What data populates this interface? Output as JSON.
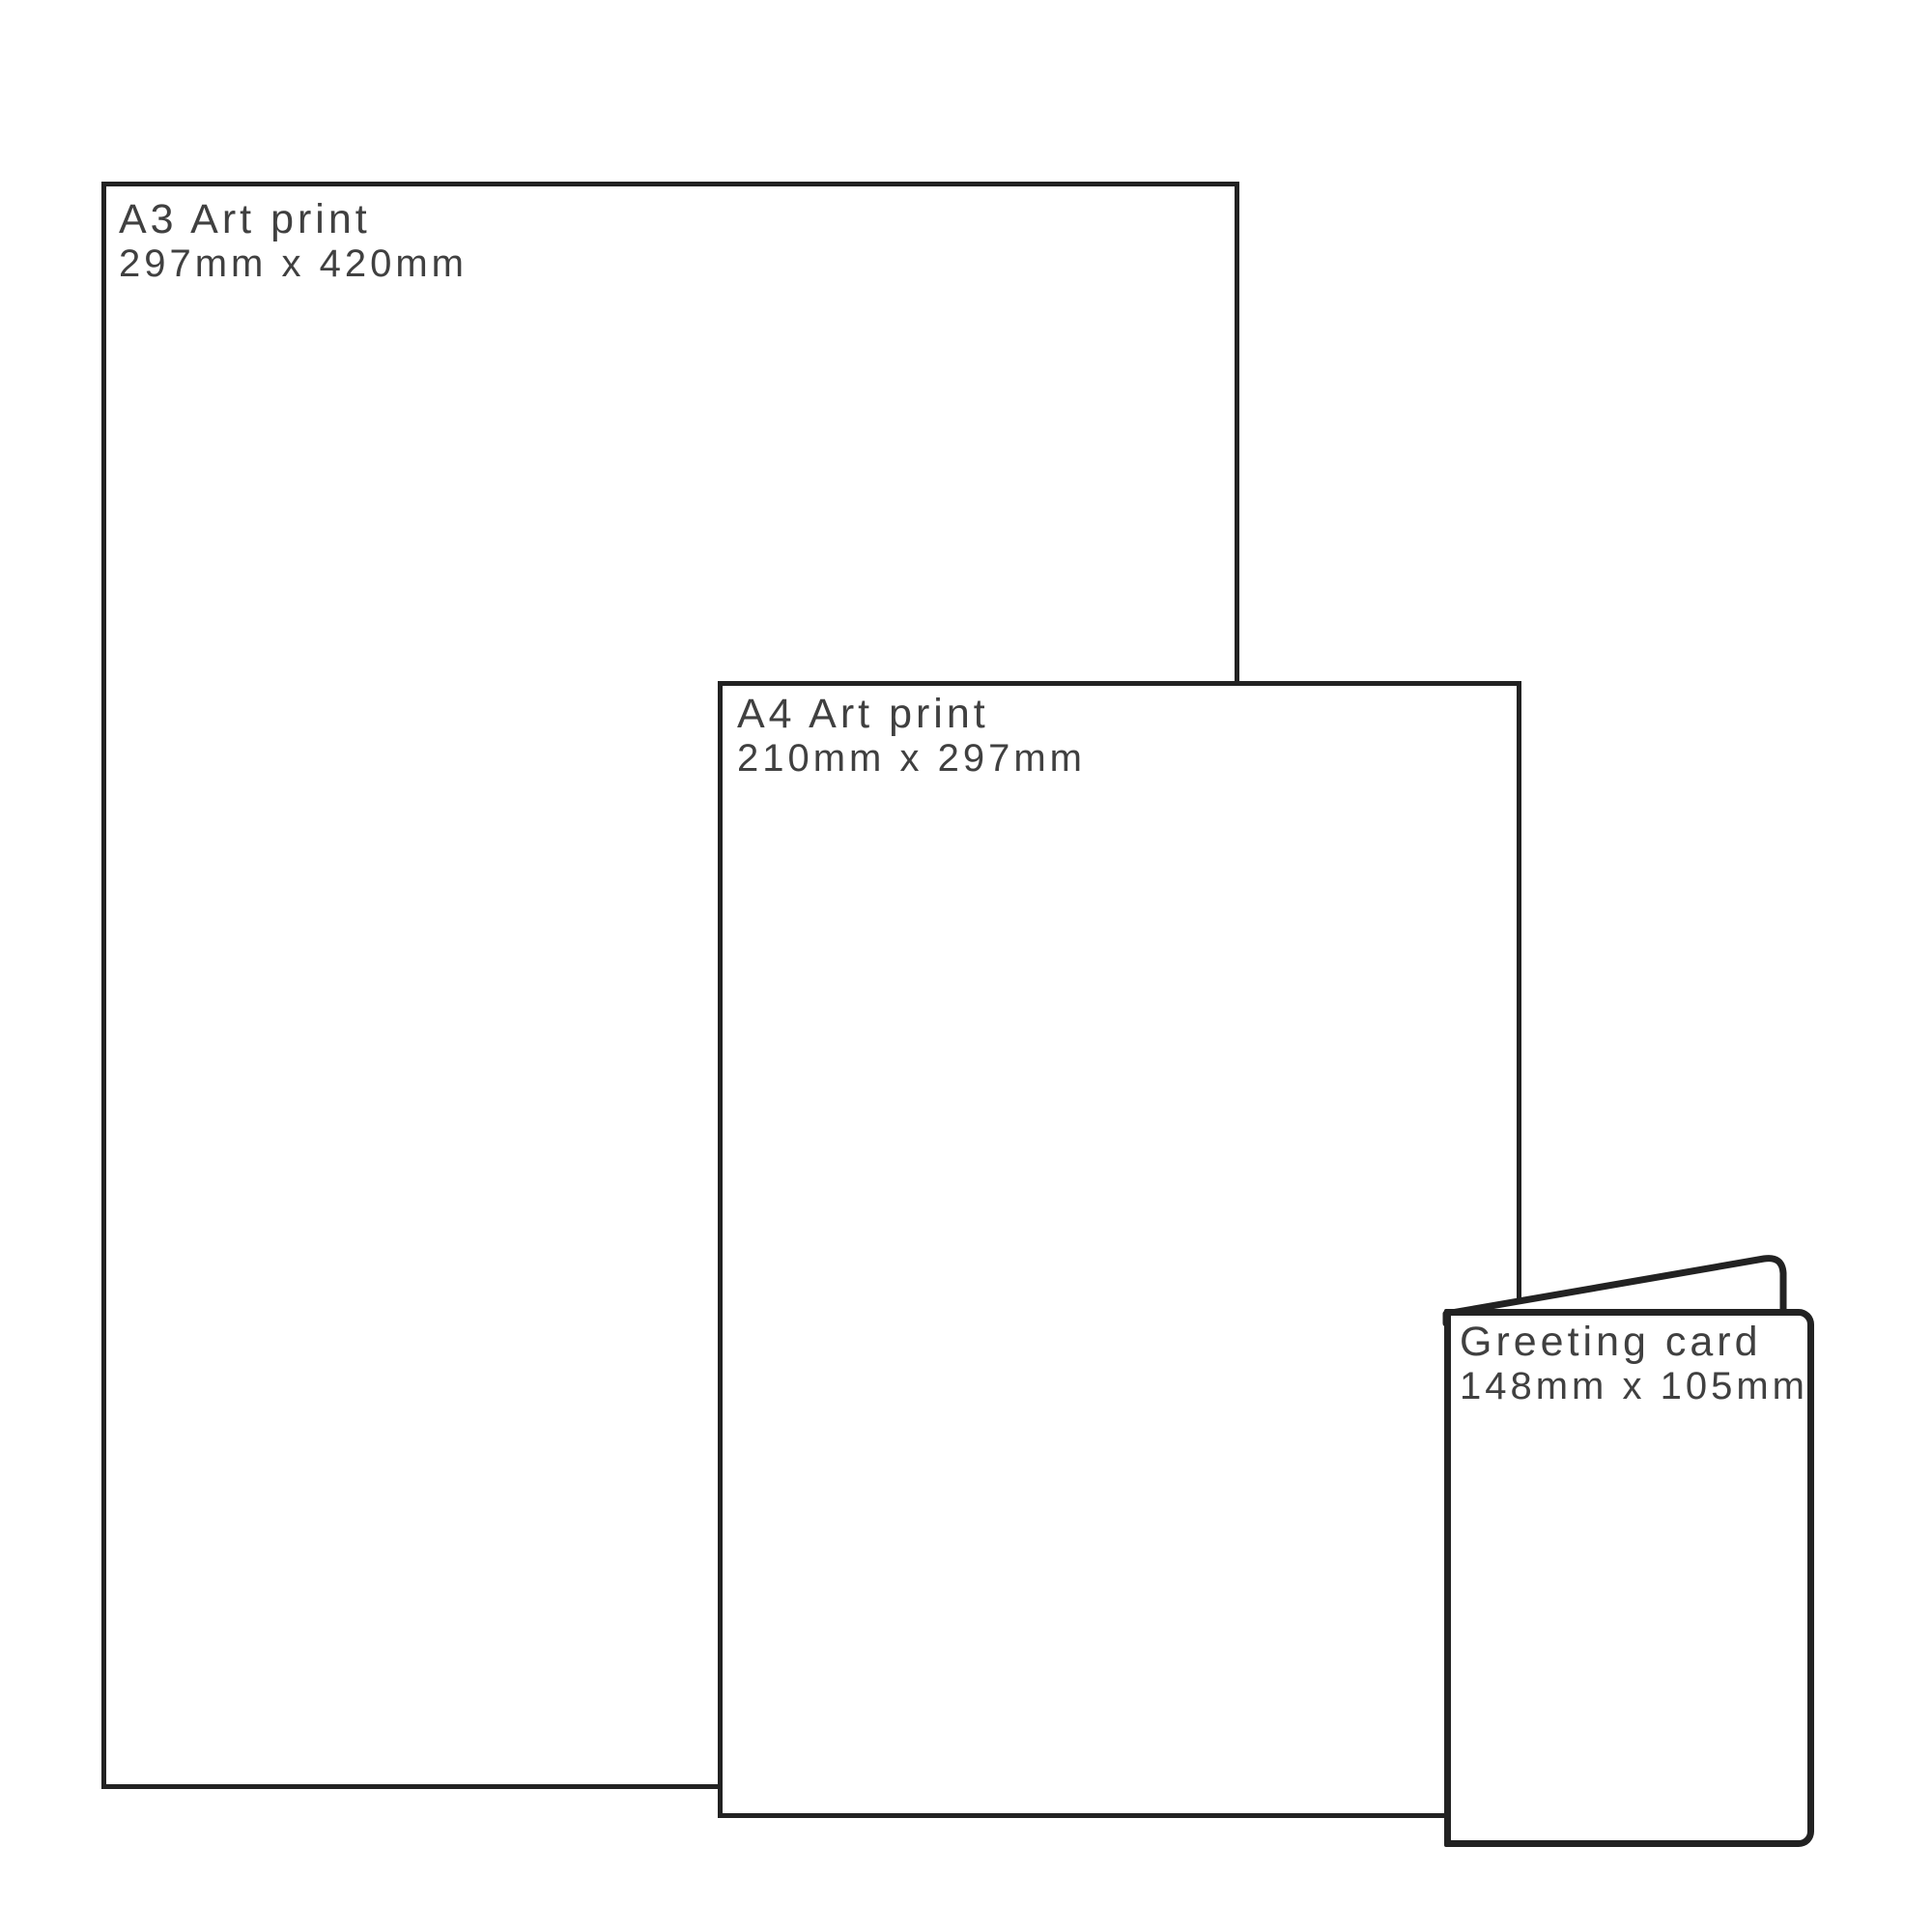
{
  "diagram": {
    "description": "Print size comparison diagram",
    "items": [
      {
        "id": "a3-print",
        "title": "A3 Art print",
        "dimensions": "297mm x 420mm"
      },
      {
        "id": "a4-print",
        "title": "A4 Art print",
        "dimensions": "210mm x 297mm"
      },
      {
        "id": "greeting-card",
        "title": "Greeting card",
        "dimensions": "148mm x 105mm"
      }
    ],
    "colors": {
      "outline": "#222222",
      "text": "#404040",
      "background": "#ffffff"
    }
  }
}
